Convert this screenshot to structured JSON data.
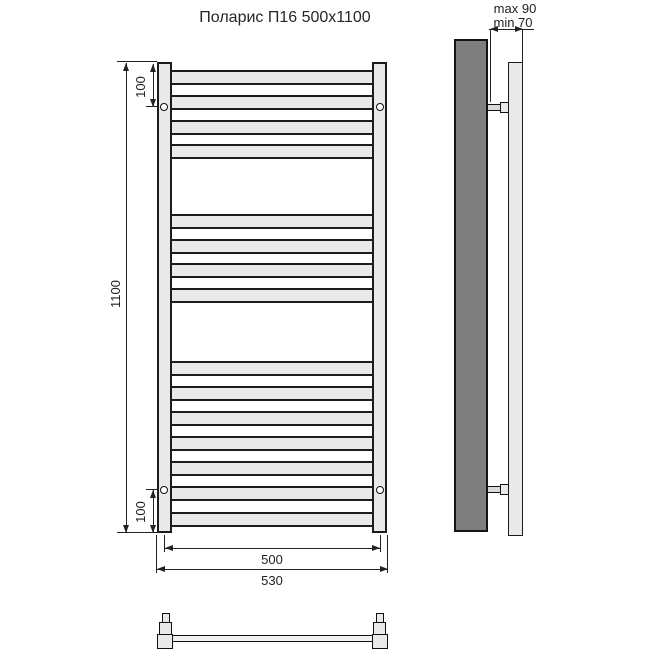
{
  "title": "Поларис П16 500x1100",
  "front_view": {
    "bars_y": [
      70,
      95,
      120,
      144,
      214,
      239,
      263,
      288,
      361,
      386,
      411,
      436,
      461,
      486,
      512
    ],
    "bar_height": 15,
    "screws_y": [
      107,
      490
    ],
    "dim_height": "1100",
    "dim_top_offset": "100",
    "dim_bottom_offset": "100",
    "dim_axis_width": "500",
    "dim_overall_width": "530"
  },
  "side_view": {
    "brackets_y": [
      102,
      484
    ],
    "dim_wall_max": "max 90",
    "dim_wall_min": "min 70"
  },
  "colors": {
    "outline": "#1c1c1c",
    "fill_light": "#e9e9e9",
    "fill_dark": "#7e7e7e",
    "dimension_line": "#222222"
  }
}
